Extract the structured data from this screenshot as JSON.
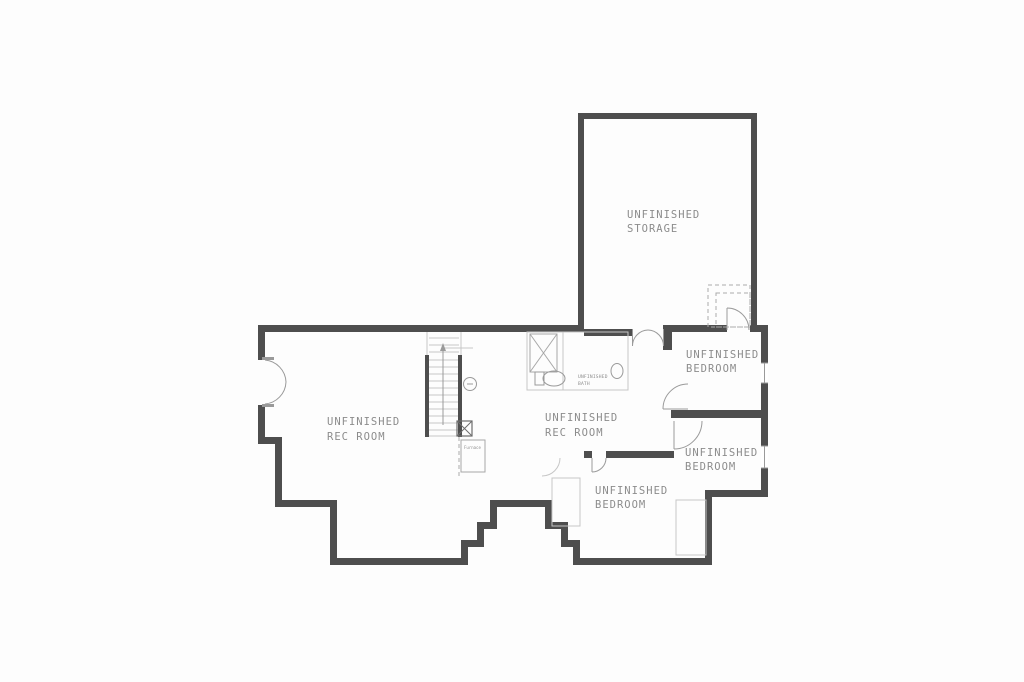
{
  "plan": {
    "type": "basement-floor-plan",
    "background_color": "#fdfdfd",
    "wall_color": "#4e4e4e",
    "light_line_color": "#c6c6c6",
    "label_color": "#8c8c8c"
  },
  "rooms": {
    "storage": {
      "line1": "UNFINISHED",
      "line2": "STORAGE"
    },
    "bedroom_right_top": {
      "line1": "UNFINISHED",
      "line2": "BEDROOM"
    },
    "bedroom_right_bottom": {
      "line1": "UNFINISHED",
      "line2": "BEDROOM"
    },
    "bedroom_bottom": {
      "line1": "UNFINISHED",
      "line2": "BEDROOM"
    },
    "rec_room_left": {
      "line1": "UNFINISHED",
      "line2": "REC ROOM"
    },
    "rec_room_center": {
      "line1": "UNFINISHED",
      "line2": "REC ROOM"
    },
    "bath": {
      "line1": "UNFINISHED",
      "line2": "BATH"
    }
  },
  "fixtures": {
    "furnace_label": "Furnace",
    "feature_names": [
      "staircase",
      "stair-direction-arrow",
      "furnace",
      "utility-box",
      "floor-drain",
      "toilet",
      "sink",
      "shower",
      "french-door",
      "double-door",
      "interior-door",
      "window",
      "dashed-stair-landing"
    ]
  }
}
